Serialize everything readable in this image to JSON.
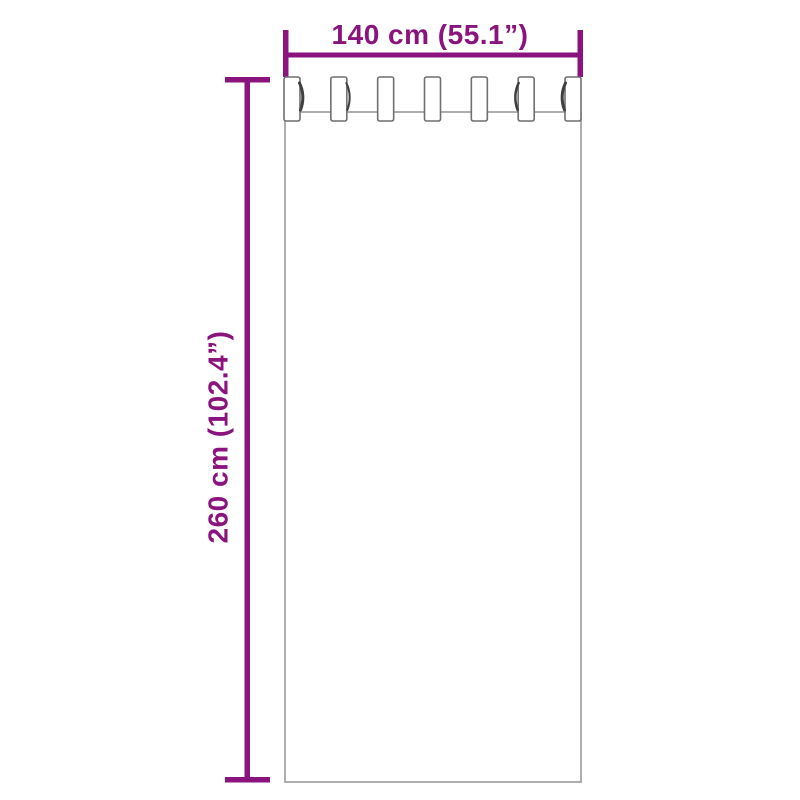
{
  "diagram": {
    "kind": "curtain-dimension-diagram",
    "background_color": "#FFFFFF",
    "accent_color": "#8A137E",
    "curtain_outline_color": "#9A9A9A",
    "tab_outline_color": "#6F6F6F",
    "width_dimension": {
      "label": "140 cm (55.1”)",
      "value_cm": 140,
      "value_in": 55.1
    },
    "height_dimension": {
      "label": "260 cm (102.4”)",
      "value_cm": 260,
      "value_in": 102.4
    },
    "curtain": {
      "tab_count": 7
    }
  }
}
